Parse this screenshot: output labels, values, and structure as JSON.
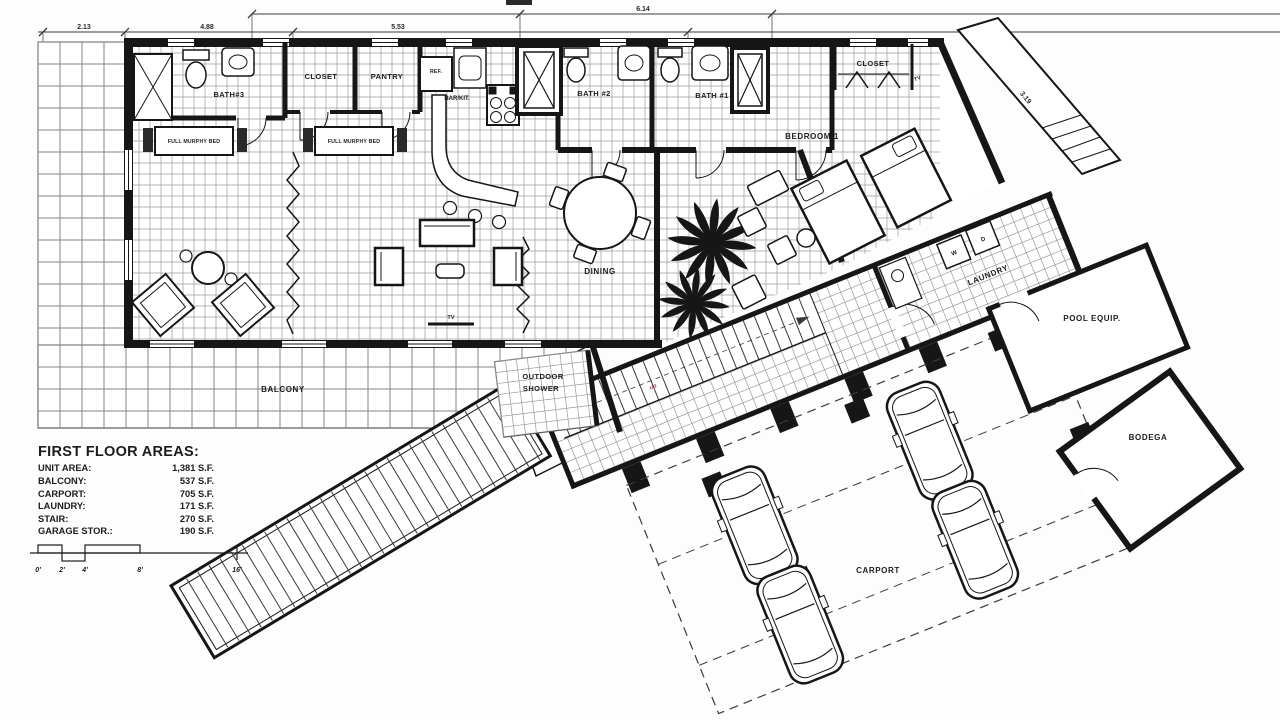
{
  "dimensions": {
    "d1": "2.13",
    "d2": "4.88",
    "d3": "5.53",
    "d4": "6.14",
    "d5": "3.19"
  },
  "rooms": {
    "bath3": "BATH#3",
    "closet1": "CLOSET",
    "pantry": "PANTRY",
    "ref": "REF.",
    "bar_kit": "BAR/KIT.",
    "bath2": "BATH #2",
    "bath1": "BATH #1",
    "closet2": "CLOSET",
    "tv_bedroom": "TV",
    "bedroom1": "BEDROOM 1",
    "dining": "DINING",
    "tv_living": "TV",
    "murphy_bed": "FULL MURPHY BED",
    "balcony": "BALCONY",
    "outdoor_shower_line1": "OUTDOOR",
    "outdoor_shower_line2": "SHOWER",
    "laundry": "LAUNDRY",
    "washer": "W",
    "dryer": "D",
    "stair_up": "up",
    "pool_equip": "POOL EQUIP.",
    "bodega": "BODEGA",
    "carport": "CARPORT"
  },
  "areas": {
    "title": "FIRST FLOOR AREAS:",
    "rows": [
      {
        "label": "UNIT AREA:",
        "value": "1,381 S.F."
      },
      {
        "label": "BALCONY:",
        "value": "537 S.F."
      },
      {
        "label": "CARPORT:",
        "value": "705 S.F."
      },
      {
        "label": "LAUNDRY:",
        "value": "171 S.F."
      },
      {
        "label": "STAIR:",
        "value": "270 S.F."
      },
      {
        "label": "GARAGE STOR.:",
        "value": "190 S.F."
      }
    ]
  },
  "scale_bar": {
    "labels": [
      "0'",
      "2'",
      "4'",
      "8'",
      "16'"
    ]
  }
}
